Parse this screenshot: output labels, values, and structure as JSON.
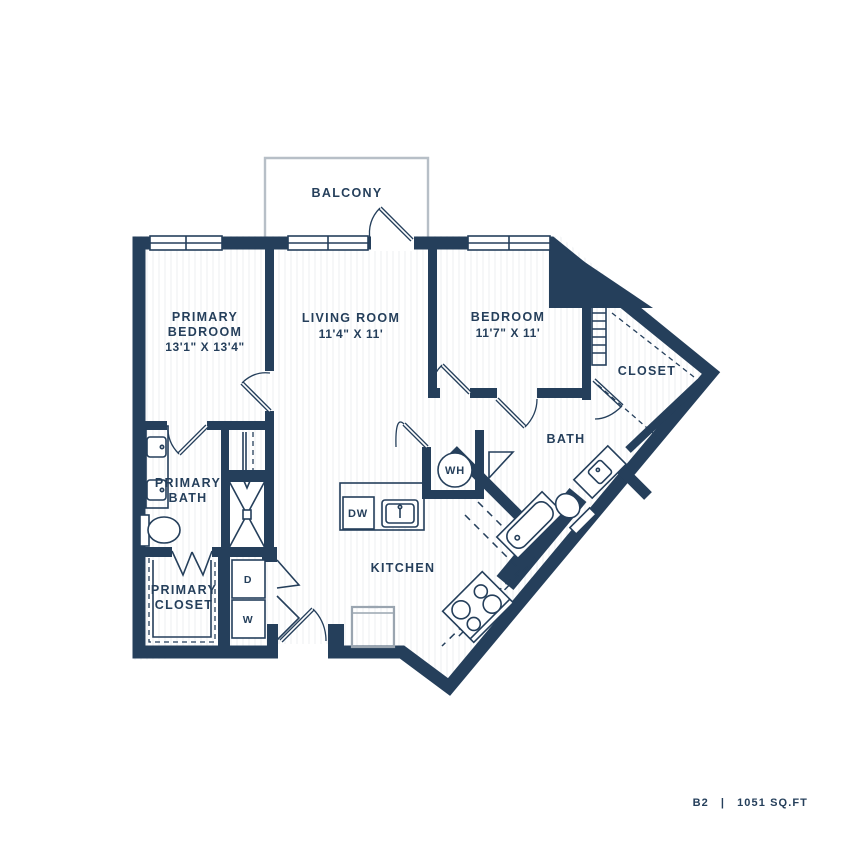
{
  "colors": {
    "wall": "#253f5b",
    "fixture_gray": "#9aa5b0",
    "balcony_outline": "#b7bfc7",
    "stripe": "#eef1f4",
    "background": "#ffffff"
  },
  "rooms": {
    "balcony": {
      "name": "BALCONY"
    },
    "primary_bedroom": {
      "line1": "PRIMARY",
      "line2": "BEDROOM",
      "dims": "13'1\" X 13'4\""
    },
    "living_room": {
      "name": "LIVING ROOM",
      "dims": "11'4\" X 11'"
    },
    "bedroom": {
      "name": "BEDROOM",
      "dims": "11'7\" X 11'"
    },
    "closet": {
      "name": "CLOSET"
    },
    "bath": {
      "name": "BATH"
    },
    "primary_bath": {
      "line1": "PRIMARY",
      "line2": "BATH"
    },
    "primary_closet": {
      "line1": "PRIMARY",
      "line2": "CLOSET"
    },
    "kitchen": {
      "name": "KITCHEN"
    }
  },
  "appliances": {
    "water_heater": "WH",
    "dishwasher": "DW",
    "dryer": "D",
    "washer": "W"
  },
  "footer": {
    "unit": "B2",
    "separator": "|",
    "area": "1051 SQ.FT"
  }
}
